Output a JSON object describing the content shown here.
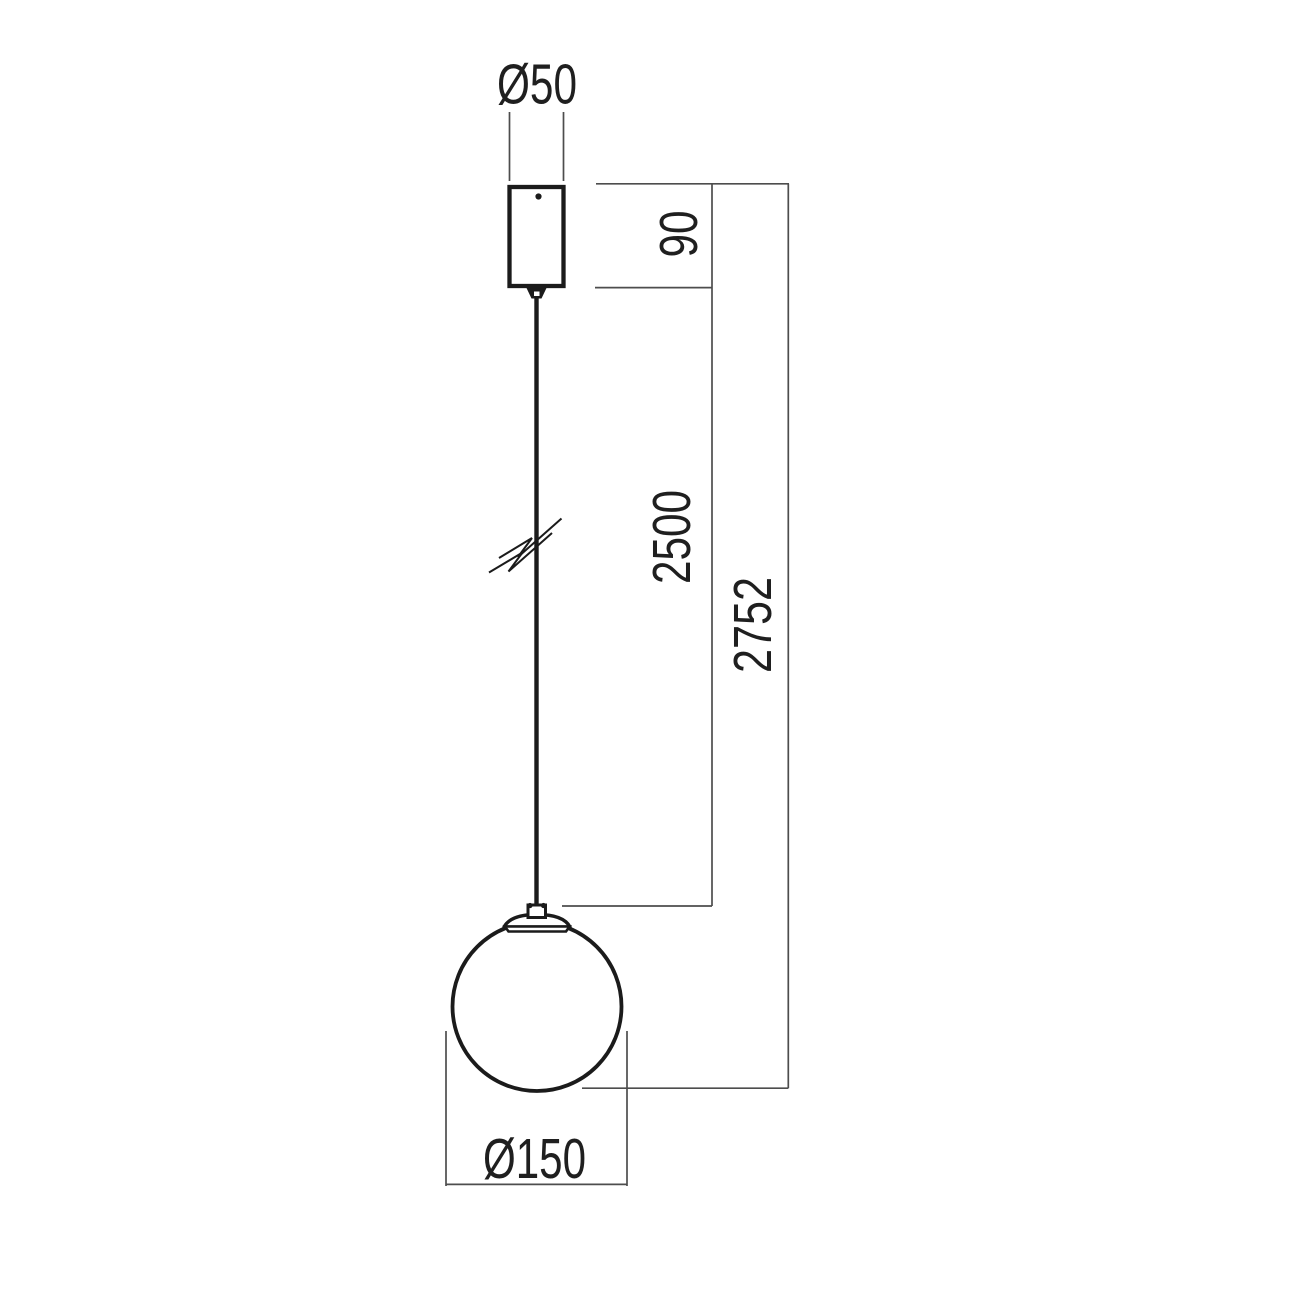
{
  "drawing": {
    "kind": "technical-dimension-drawing",
    "subject": "globe-pendant-lamp",
    "background": "#ffffff",
    "colors": {
      "object_line": "#1b1b1b",
      "dimension_line": "#4d4d4d",
      "text": "#1f1f1f",
      "fill_white": "#ffffff"
    },
    "labels": {
      "canopy_diameter": "Ø50",
      "canopy_height": "90",
      "suspension_length": "2500",
      "overall_drop": "2752",
      "globe_diameter": "Ø150"
    },
    "values_mm": {
      "canopy_diameter": 50,
      "canopy_height": 90,
      "suspension_length": 2500,
      "overall_drop": 2752,
      "globe_diameter": 150
    }
  }
}
